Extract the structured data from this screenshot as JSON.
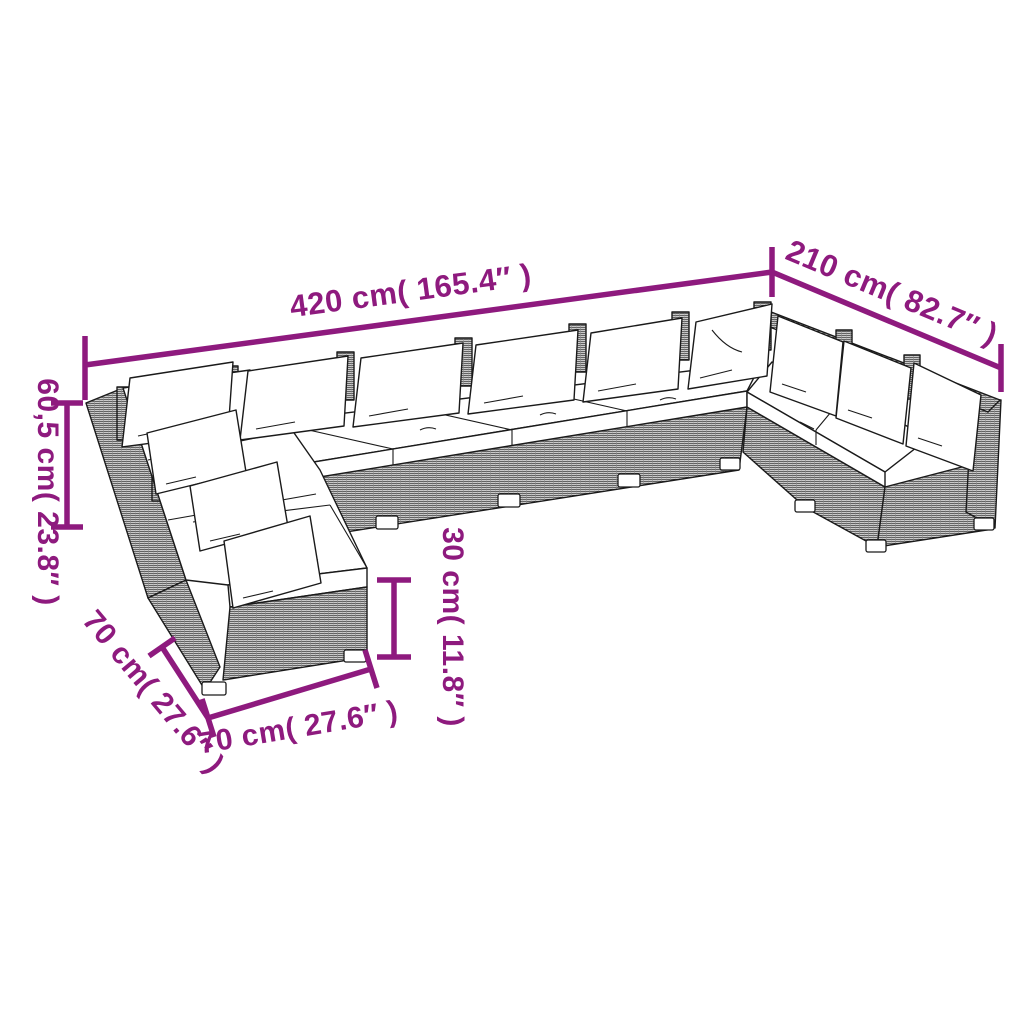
{
  "figure": {
    "description": "Line-drawing dimension diagram of a U-shaped poly rattan garden lounge set with white cushions and back pillows",
    "accent_color": "#8E1A7E",
    "art_color": "#1a1a1a",
    "background": "#ffffff",
    "dimensions": [
      {
        "id": "total-width",
        "label": "420 cm( 165.4″ )"
      },
      {
        "id": "total-depth",
        "label": "210 cm( 82.7″ )"
      },
      {
        "id": "back-height",
        "label": "60,5 cm( 23.8″ )"
      },
      {
        "id": "seat-height",
        "label": "30 cm( 11.8″ )"
      },
      {
        "id": "module-depth",
        "label": "70 cm( 27.6″ )"
      },
      {
        "id": "module-width",
        "label": "70 cm( 27.6″ )"
      }
    ]
  }
}
